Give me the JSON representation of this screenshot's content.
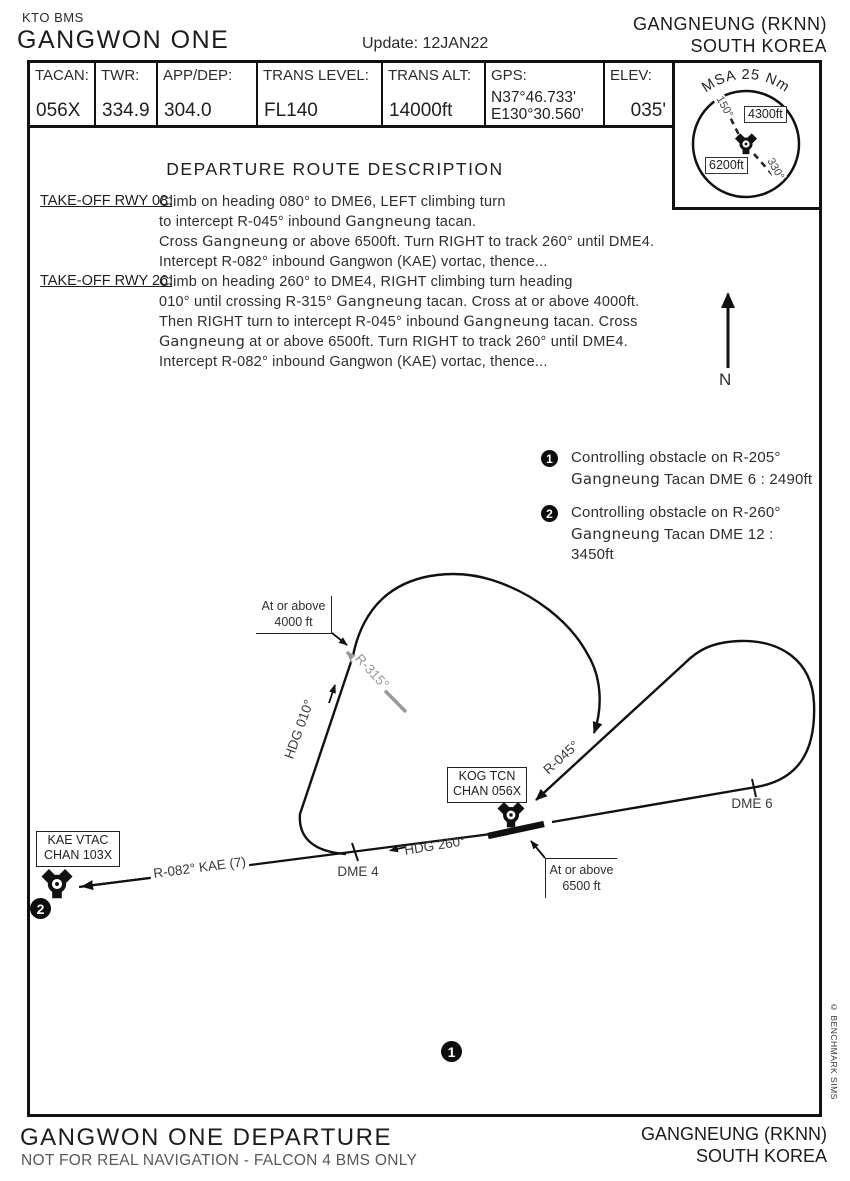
{
  "header": {
    "series": "KTO BMS",
    "title": "GANGWON ONE",
    "update": "Update: 12JAN22",
    "airport": "GANGNEUNG (RKNN)",
    "country": "SOUTH KOREA"
  },
  "infobar": {
    "cells": [
      {
        "label": "TACAN:",
        "lines": [
          "056X"
        ]
      },
      {
        "label": "TWR:",
        "lines": [
          "334.9"
        ]
      },
      {
        "label": "APP/DEP:",
        "lines": [
          "304.0"
        ]
      },
      {
        "label": "TRANS LEVEL:",
        "lines": [
          "FL140"
        ]
      },
      {
        "label": "TRANS ALT:",
        "lines": [
          "14000ft"
        ]
      },
      {
        "label": "GPS:",
        "lines": [
          "N37°46.733'",
          "E130°30.560'"
        ]
      },
      {
        "label": "ELEV:",
        "lines": [
          "035'"
        ]
      }
    ]
  },
  "msa": {
    "title": "MSA 25 Nm",
    "sector_high": "4300ft",
    "sector_low": "6200ft",
    "bearing_150": "150°",
    "bearing_330": "330°"
  },
  "route_description": {
    "title": "DEPARTURE ROUTE DESCRIPTION",
    "rwy08": {
      "label": "TAKE-OFF RWY 08:",
      "lines": [
        [
          {
            "t": "Climb on heading 080° to DME6, LEFT climbing turn"
          }
        ],
        [
          {
            "t": "to intercept R-045° inbound "
          },
          {
            "t": "Gangneung",
            "alt": true
          },
          {
            "t": " tacan."
          }
        ],
        [
          {
            "t": "Cross "
          },
          {
            "t": "Gangneung",
            "alt": true
          },
          {
            "t": " or above 6500ft. Turn RIGHT to track 260° until DME4."
          }
        ],
        [
          {
            "t": "Intercept  R-082° inbound Gangwon (KAE) vortac, thence..."
          }
        ]
      ]
    },
    "rwy26": {
      "label": "TAKE-OFF RWY 26:",
      "lines": [
        [
          {
            "t": "Climb on heading 260° to DME4, RIGHT climbing turn heading"
          }
        ],
        [
          {
            "t": "010° until crossing R-315° "
          },
          {
            "t": "Gangneung",
            "alt": true
          },
          {
            "t": " tacan. Cross at or above 4000ft."
          }
        ],
        [
          {
            "t": "Then RIGHT turn to intercept R-045° inbound "
          },
          {
            "t": "Gangneung",
            "alt": true
          },
          {
            "t": " tacan. Cross"
          }
        ],
        [
          {
            "t": "Gangneung",
            "alt": true
          },
          {
            "t": " at or above 6500ft. Turn RIGHT to track 260° until DME4."
          }
        ],
        [
          {
            "t": "Intercept  R-082° inbound Gangwon (KAE) vortac, thence..."
          }
        ]
      ]
    }
  },
  "notes": [
    {
      "num": "1",
      "lines": [
        [
          {
            "t": "Controlling obstacle on R-205°"
          }
        ],
        [
          {
            "t": "Gangneung",
            "alt": true
          },
          {
            "t": " Tacan DME 6 : 2490ft"
          }
        ]
      ]
    },
    {
      "num": "2",
      "lines": [
        [
          {
            "t": "Controlling obstacle on R-260°"
          }
        ],
        [
          {
            "t": "Gangneung",
            "alt": true
          },
          {
            "t": " Tacan DME 12 :"
          }
        ],
        [
          {
            "t": "3450ft"
          }
        ]
      ]
    }
  ],
  "compass": {
    "north": "N"
  },
  "diagram": {
    "kog_box": [
      "KOG TCN",
      "CHAN 056X"
    ],
    "kae_box": [
      "KAE VTAC",
      "CHAN 103X"
    ],
    "labels": {
      "hdg010": "HDG 010°",
      "hdg260": "HDG 260°",
      "r315": "R-315°",
      "r045": "R-045°",
      "r082": "R-082° KAE (7)",
      "dme4": "DME 4",
      "dme6": "DME 6",
      "at4000": [
        "At or above",
        "4000 ft"
      ],
      "at6500": [
        "At or above",
        "6500 ft"
      ]
    }
  },
  "footer": {
    "title": "GANGWON ONE DEPARTURE",
    "disclaimer": "NOT FOR REAL NAVIGATION - FALCON 4 BMS ONLY",
    "airport": "GANGNEUNG (RKNN)",
    "country": "SOUTH KOREA"
  },
  "credit": "© BENCHMARK SIMS"
}
